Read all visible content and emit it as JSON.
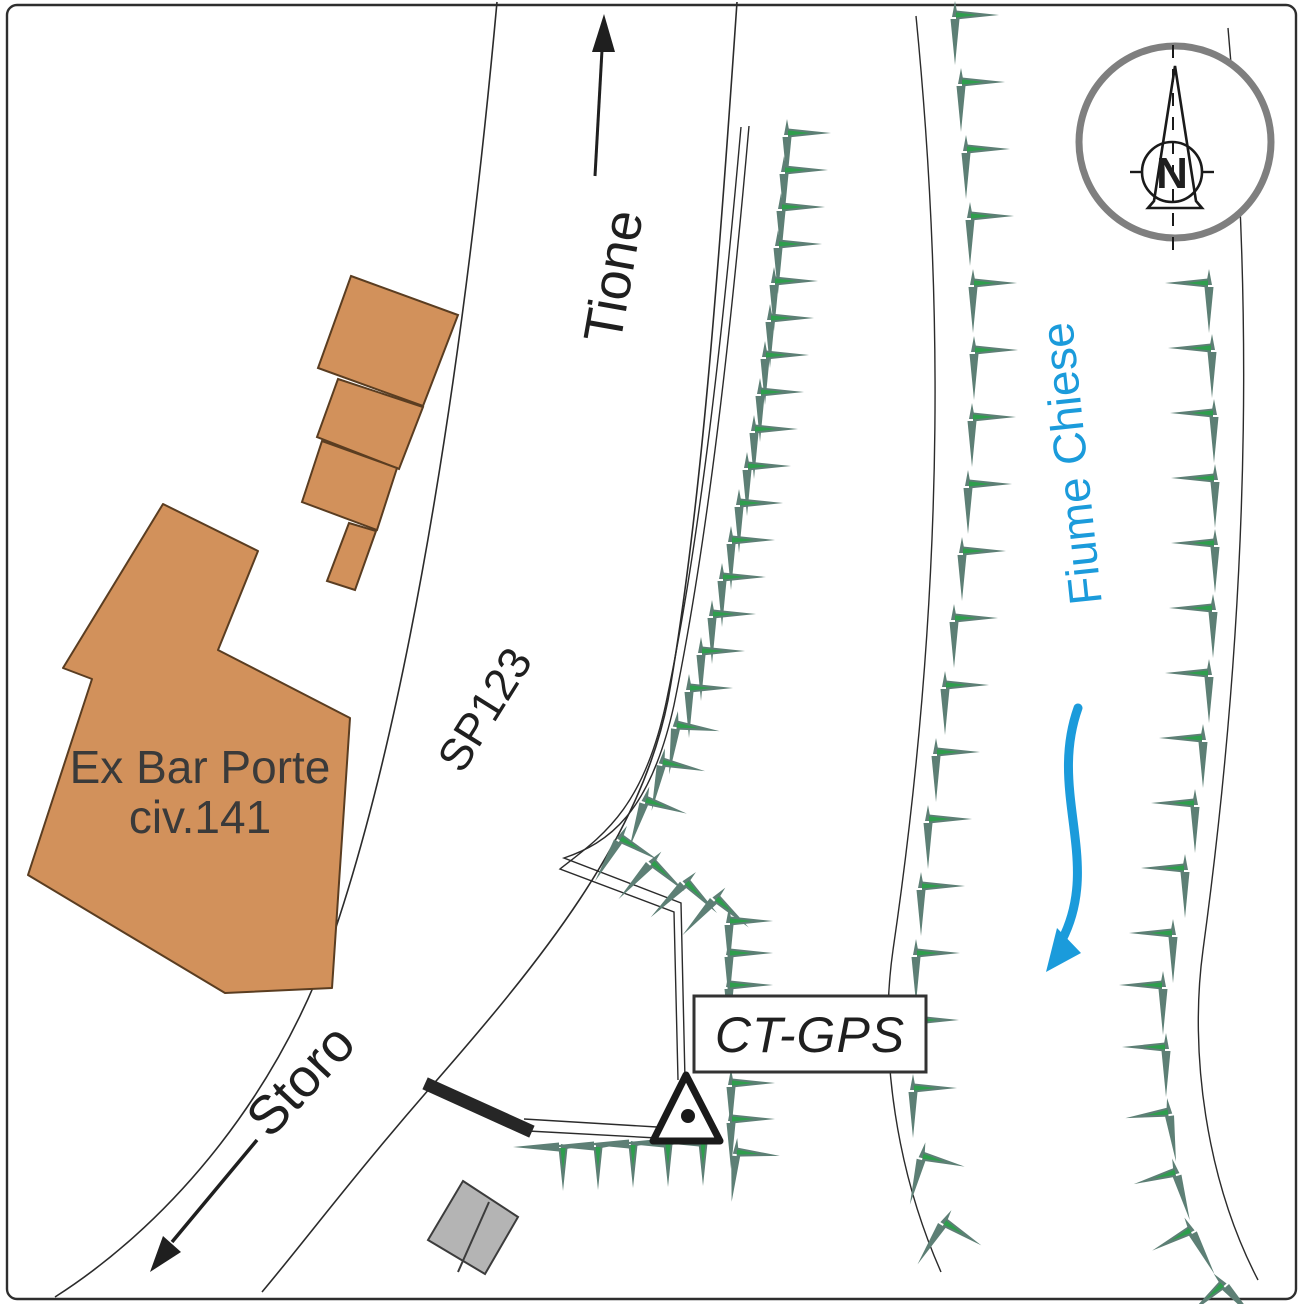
{
  "labels": {
    "north": "N",
    "dir_up": "Tione",
    "dir_down": "Storo",
    "road": "SP123",
    "river": "Fiume Chiese",
    "building_line1": "Ex Bar Porte",
    "building_line2": "civ.141",
    "station": "CT-GPS"
  },
  "colors": {
    "ink": "#1f1f1f",
    "building_fill": "#d2915b",
    "building_stroke": "#5a3d21",
    "gray_building_fill": "#b4b4b4",
    "gray_building_stroke": "#3c3c3c",
    "tree_main": "#5d7f75",
    "tree_accent": "#2e9e4d",
    "water_blue": "#1b9bdb",
    "compass_ring": "#7f7f7f",
    "wall": "#262626"
  },
  "geometry": {
    "border": {
      "x": 7,
      "y": 5,
      "w": 1289,
      "h": 1294,
      "rx": 10
    },
    "road_left_d": "M 497 2 C 468 320 415 700 330 945 C 270 1110 160 1230 55 1297",
    "road_right_d": "M 737 2 C 718 280 700 520 668 700 C 640 840 540 962 430 1088 C 350 1180 304 1242 262 1292",
    "guard_outer_d": "M 749 126 C 731 330 708 540 674 705 C 650 814 608 843 564 858 L 681 903 L 685 1080",
    "guard_inner_d": "M 741 127 C 723 331 700 541 666 703 C 643 810 602 836 560 869 L 674 912 L 678 1080",
    "river_left_d": "M 916 16 C 940 260 950 560 893 950 C 878 1055 898 1175 941 1272",
    "river_right_d": "M 1228 28 C 1249 260 1256 560 1203 950 C 1189 1052 1206 1180 1258 1280",
    "pad_line_top": {
      "x1": 524,
      "y1": 1119,
      "x2": 657,
      "y2": 1127
    },
    "pad_line_bot": {
      "x1": 528,
      "y1": 1131,
      "x2": 657,
      "y2": 1138
    },
    "wall": {
      "x1": 431,
      "y1": 1086,
      "x2": 526,
      "y2": 1129
    },
    "main_building_pts": "163 504 258 551 218 650 350 718 332 988 225 993 28 875 92 679 63 668",
    "annex": {
      "0": "351 276 458 315 423 406 318 368",
      "1": "338 379 423 407 399 469 317 437",
      "2": "322 441 397 468 377 530 302 502",
      "3": "349 523 376 531 355 590 327 581"
    },
    "gray_outer_pts": "463 1181 518 1217 485 1274 428 1240",
    "gray_divider": {
      "x1": 489,
      "y1": 1202,
      "x2": 458,
      "y2": 1272
    },
    "triangle_pts": "686 1075 653 1141 720 1141",
    "dot": {
      "cx": 688,
      "cy": 1116,
      "r": 7
    },
    "box": {
      "x": 694,
      "y": 996,
      "w": 232,
      "h": 76
    },
    "tione_arrow": {
      "shaft": {
        "x1": 595,
        "y1": 176,
        "x2": 602,
        "y2": 50
      },
      "head_pts": "592 52 615 52 604 14"
    },
    "storo_arrow": {
      "shaft": {
        "x1": 257,
        "y1": 1140,
        "x2": 172,
        "y2": 1242
      },
      "head_pts": "150 1272 181 1252 163 1236"
    },
    "flow_d": "M 1078 708 C 1048 792 1102 862 1062 940",
    "flow_head_pts": "1046 972 1081 953 1057 928",
    "compass": {
      "ring": {
        "cx": 1175,
        "cy": 142,
        "r": 96
      },
      "needle_pts": "1175 66 1196 201 1202 208 1148 208 1154 201",
      "inner": {
        "cx": 1172,
        "cy": 172,
        "r": 30
      },
      "axis": {
        "x1": 1173,
        "y1": 45,
        "x2": 1173,
        "y2": 250
      },
      "tick_left": {
        "x1": 1130,
        "y1": 172,
        "x2": 1143,
        "y2": 172
      },
      "tick_right": {
        "x1": 1201,
        "y1": 172,
        "x2": 1214,
        "y2": 172
      }
    }
  },
  "trees": [
    [
      787,
      133
    ],
    [
      784,
      170
    ],
    [
      781,
      207
    ],
    [
      778,
      244
    ],
    [
      774,
      281
    ],
    [
      770,
      318
    ],
    [
      765,
      355
    ],
    [
      760,
      392
    ],
    [
      754,
      429
    ],
    [
      747,
      466
    ],
    [
      739,
      503
    ],
    [
      731,
      540
    ],
    [
      722,
      577
    ],
    [
      712,
      614
    ],
    [
      701,
      651
    ],
    [
      689,
      688
    ],
    [
      676,
      725,
      8
    ],
    [
      662,
      762,
      12
    ],
    [
      645,
      800,
      18
    ],
    [
      620,
      838,
      30
    ],
    [
      652,
      862,
      42
    ],
    [
      686,
      882,
      45
    ],
    [
      716,
      898,
      42
    ],
    [
      729,
      921
    ],
    [
      729,
      953
    ],
    [
      729,
      985
    ],
    [
      731,
      1083
    ],
    [
      731,
      1119
    ],
    [
      736,
      1152,
      5
    ],
    [
      563,
      1147,
      90
    ],
    [
      598,
      1146,
      90
    ],
    [
      633,
      1144,
      90
    ],
    [
      668,
      1143,
      90
    ],
    [
      703,
      1142,
      90
    ],
    [
      955,
      15
    ],
    [
      961,
      82
    ],
    [
      966,
      149
    ],
    [
      970,
      216
    ],
    [
      973,
      283
    ],
    [
      974,
      350
    ],
    [
      972,
      417
    ],
    [
      968,
      484
    ],
    [
      962,
      551
    ],
    [
      954,
      618
    ],
    [
      945,
      685
    ],
    [
      936,
      752
    ],
    [
      928,
      819
    ],
    [
      921,
      886
    ],
    [
      916,
      953
    ],
    [
      915,
      1020
    ],
    [
      913,
      1088
    ],
    [
      922,
      1156,
      14
    ],
    [
      944,
      1222,
      32
    ],
    [
      1209,
      283,
      0,
      -1
    ],
    [
      1212,
      348,
      0,
      -1
    ],
    [
      1214,
      413,
      0,
      -1
    ],
    [
      1215,
      478,
      0,
      -1
    ],
    [
      1215,
      543,
      0,
      -1
    ],
    [
      1213,
      608,
      0,
      -1
    ],
    [
      1209,
      673,
      0,
      -1
    ],
    [
      1203,
      738,
      0,
      -1
    ],
    [
      1195,
      803,
      0,
      -1
    ],
    [
      1185,
      868,
      0,
      -1
    ],
    [
      1173,
      933,
      0,
      -1
    ],
    [
      1163,
      985,
      0,
      -1
    ],
    [
      1166,
      1047,
      0,
      -1
    ],
    [
      1169,
      1112,
      -8,
      -1
    ],
    [
      1176,
      1172,
      -16,
      -1
    ],
    [
      1191,
      1230,
      -28,
      -1
    ],
    [
      1223,
      1284,
      -42,
      -1
    ]
  ]
}
